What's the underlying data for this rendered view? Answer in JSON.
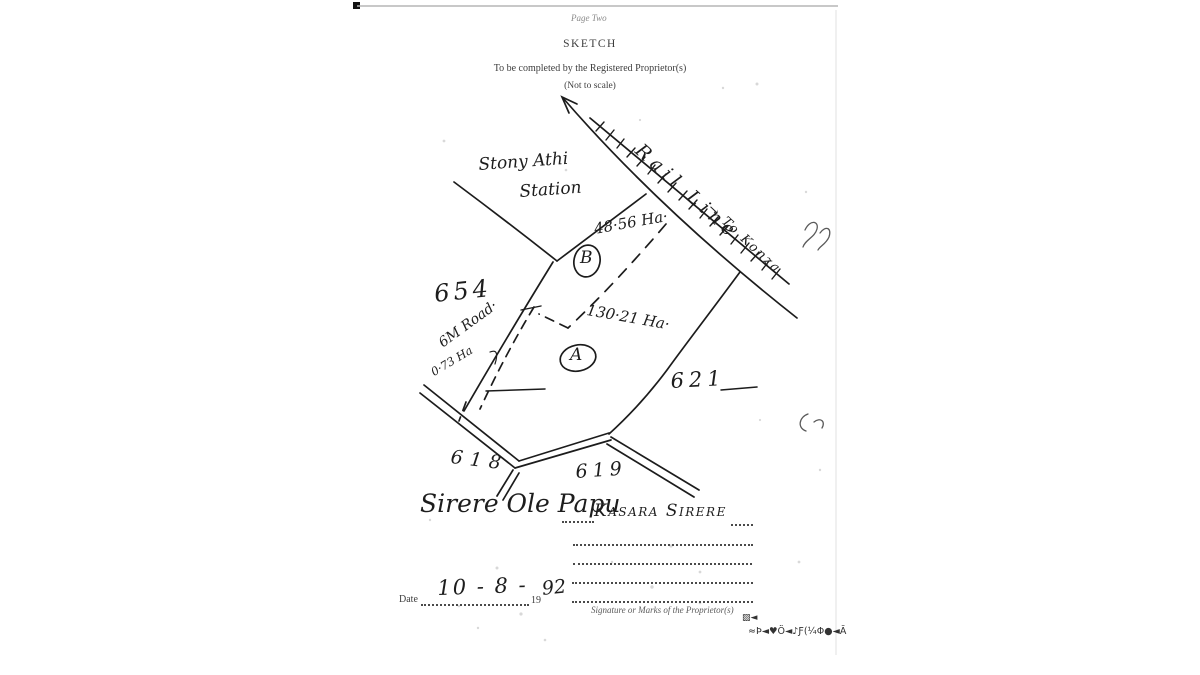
{
  "document": {
    "page_label": "Page Two",
    "title": "SKETCH",
    "instruction": "To be completed by the Registered Proprietor(s)",
    "scale_note": "(Not to scale)"
  },
  "sketch": {
    "station_line1": "Stony Athi",
    "station_line2": "Station",
    "rail_label": "Rail Line",
    "rail_direction": "→ To Konza",
    "parcel_b": {
      "letter": "B",
      "area": "48·56 Ha·"
    },
    "parcel_a": {
      "letter": "A",
      "area": "130·21 Ha·"
    },
    "parcel_west": "654",
    "parcel_east": "621",
    "parcel_south_left": "618",
    "parcel_south_right": "619",
    "road": {
      "label": "6M Road·",
      "area": "0·73 Ha"
    }
  },
  "signatures": {
    "proprietor_1": "Sirere Ole Papu",
    "proprietor_2": "Kasara Sirere",
    "caption": "Signature or Marks of the Proprietor(s)"
  },
  "date": {
    "label": "Date",
    "value": "10 - 8 -",
    "year_prefix": "19",
    "year_value": "92"
  },
  "artifacts": {
    "row1": "▨◄",
    "row2": "≈Ϸ◄♥Ö◄♪Ƒ(¼Φ●◄Ā"
  },
  "colors": {
    "ink": "#1c1c1c",
    "paper": "#ffffff"
  }
}
